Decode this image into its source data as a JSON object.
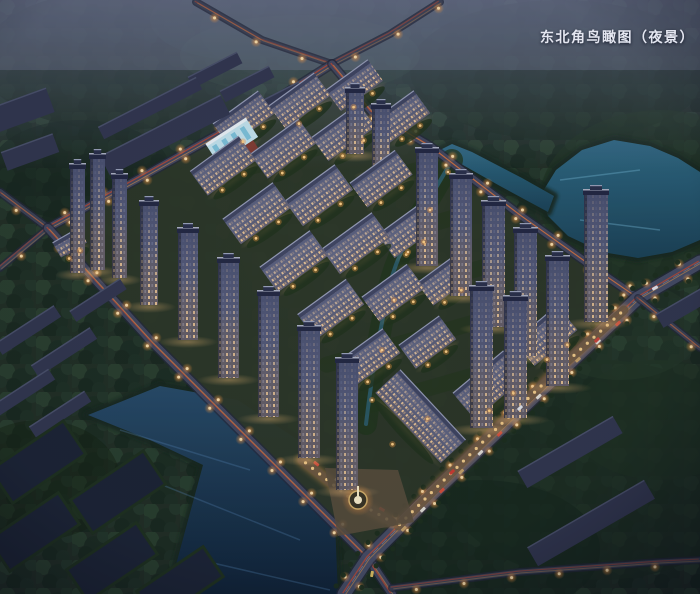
{
  "caption": {
    "text": "东北角鸟瞰图（夜景）"
  },
  "palette": {
    "night_haze": "#7a7ea5",
    "forest": "#1f2d20",
    "water_teal": "#2f6b85",
    "water_navy": "#12283c",
    "road_surface": "#4a4f68",
    "street_lamp": "#ffc270",
    "light_trail_red": "#c14a32",
    "light_trail_amber": "#e09a4f",
    "window_warm": "#ffd9a4",
    "facade": "#4e5370",
    "roof": "#2e3350",
    "retail_glow": "#fca54d"
  },
  "scene": {
    "lakes": [
      {
        "name": "northeast-lake",
        "fill": "teal",
        "points": [
          [
            540,
            196
          ],
          [
            556,
            170
          ],
          [
            582,
            150
          ],
          [
            614,
            140
          ],
          [
            650,
            146
          ],
          [
            678,
            158
          ],
          [
            700,
            172
          ],
          [
            700,
            240
          ],
          [
            672,
            252
          ],
          [
            638,
            258
          ],
          [
            602,
            252
          ],
          [
            568,
            236
          ],
          [
            548,
            216
          ]
        ]
      },
      {
        "name": "lake-inlet",
        "fill": "teal",
        "points": [
          [
            548,
            212
          ],
          [
            500,
            186
          ],
          [
            454,
            160
          ],
          [
            440,
            150
          ],
          [
            452,
            144
          ],
          [
            472,
            152
          ],
          [
            522,
            178
          ],
          [
            554,
            196
          ]
        ]
      },
      {
        "name": "southwest-lake",
        "fill": "navy",
        "points": [
          [
            88,
            415
          ],
          [
            160,
            386
          ],
          [
            238,
            400
          ],
          [
            304,
            444
          ],
          [
            334,
            498
          ],
          [
            338,
            594
          ],
          [
            168,
            594
          ],
          [
            203,
            465
          ],
          [
            150,
            440
          ]
        ]
      }
    ],
    "roads": [
      {
        "name": "forest-road-west",
        "kind": "minor",
        "w": 5,
        "points": [
          [
            196,
            2
          ],
          [
            262,
            40
          ],
          [
            332,
            64
          ]
        ]
      },
      {
        "name": "forest-road-east",
        "kind": "minor",
        "w": 5,
        "points": [
          [
            332,
            64
          ],
          [
            390,
            34
          ],
          [
            440,
            2
          ]
        ]
      },
      {
        "name": "northwest-perimeter-road",
        "kind": "perimeter",
        "w": 7,
        "points": [
          [
            48,
            228
          ],
          [
            140,
            178
          ],
          [
            240,
            122
          ],
          [
            332,
            64
          ]
        ]
      },
      {
        "name": "west-approach-road",
        "kind": "minor",
        "w": 6,
        "points": [
          [
            0,
            192
          ],
          [
            48,
            228
          ]
        ]
      },
      {
        "name": "west-approach-road-south",
        "kind": "minor",
        "w": 5,
        "points": [
          [
            0,
            268
          ],
          [
            48,
            228
          ]
        ]
      },
      {
        "name": "southwest-perimeter-road",
        "kind": "perimeter",
        "w": 8,
        "points": [
          [
            48,
            228
          ],
          [
            152,
            342
          ],
          [
            258,
            448
          ],
          [
            368,
            558
          ],
          [
            392,
            594
          ]
        ]
      },
      {
        "name": "northeast-lakeside-road",
        "kind": "perimeter",
        "w": 7,
        "points": [
          [
            332,
            64
          ],
          [
            372,
            112
          ],
          [
            430,
            146
          ],
          [
            520,
            215
          ],
          [
            600,
            272
          ],
          [
            638,
            298
          ]
        ]
      },
      {
        "name": "southeast-arterial-road",
        "kind": "arterial",
        "w": 13,
        "points": [
          [
            700,
            262
          ],
          [
            638,
            298
          ],
          [
            520,
            410
          ],
          [
            430,
            496
          ],
          [
            368,
            558
          ],
          [
            344,
            594
          ]
        ]
      },
      {
        "name": "east-spur-road",
        "kind": "minor",
        "w": 5,
        "points": [
          [
            638,
            298
          ],
          [
            700,
            348
          ]
        ]
      },
      {
        "name": "south-edge-road",
        "kind": "minor",
        "w": 5,
        "points": [
          [
            392,
            588
          ],
          [
            520,
            572
          ],
          [
            660,
            562
          ],
          [
            700,
            560
          ]
        ]
      }
    ],
    "green_bands": [
      {
        "cx": 320,
        "cy": 147
      },
      {
        "cx": 330,
        "cy": 195
      },
      {
        "cx": 365,
        "cy": 243
      },
      {
        "cx": 400,
        "cy": 291
      },
      {
        "cx": 420,
        "cy": 338
      },
      {
        "cx": 440,
        "cy": 385
      }
    ],
    "stream_path": "M452,160 C430,200 398,244 388,292 C380,332 372,372 366,424",
    "buildings": [
      {
        "t": "tower",
        "x": 70,
        "y": 168,
        "w": 15,
        "h": 105
      },
      {
        "t": "tower",
        "x": 90,
        "y": 158,
        "w": 15,
        "h": 112
      },
      {
        "t": "tower",
        "x": 112,
        "y": 178,
        "w": 15,
        "h": 100
      },
      {
        "t": "tower",
        "x": 140,
        "y": 205,
        "w": 18,
        "h": 100
      },
      {
        "t": "tower",
        "x": 178,
        "y": 232,
        "w": 20,
        "h": 108
      },
      {
        "t": "tower",
        "x": 218,
        "y": 262,
        "w": 21,
        "h": 116
      },
      {
        "t": "tower",
        "x": 258,
        "y": 295,
        "w": 21,
        "h": 122
      },
      {
        "t": "tower",
        "x": 298,
        "y": 330,
        "w": 22,
        "h": 128
      },
      {
        "t": "tower",
        "x": 336,
        "y": 362,
        "w": 22,
        "h": 128
      },
      {
        "t": "tower",
        "x": 346,
        "y": 92,
        "w": 18,
        "h": 62
      },
      {
        "t": "tower",
        "x": 372,
        "y": 108,
        "w": 18,
        "h": 66
      },
      {
        "t": "tower",
        "x": 416,
        "y": 152,
        "w": 22,
        "h": 114
      },
      {
        "t": "tower",
        "x": 450,
        "y": 178,
        "w": 22,
        "h": 118
      },
      {
        "t": "tower",
        "x": 482,
        "y": 205,
        "w": 23,
        "h": 122
      },
      {
        "t": "tower",
        "x": 514,
        "y": 232,
        "w": 23,
        "h": 124
      },
      {
        "t": "tower",
        "x": 546,
        "y": 260,
        "w": 23,
        "h": 126
      },
      {
        "t": "tower",
        "x": 584,
        "y": 194,
        "w": 24,
        "h": 128
      },
      {
        "t": "tower",
        "x": 470,
        "y": 290,
        "w": 23,
        "h": 138
      },
      {
        "t": "tower",
        "x": 504,
        "y": 300,
        "w": 23,
        "h": 118
      },
      {
        "t": "slab",
        "cx": 252,
        "cy": 130,
        "len": 56,
        "h": 24,
        "rot": -36
      },
      {
        "t": "slab",
        "cx": 308,
        "cy": 112,
        "len": 56,
        "h": 24,
        "rot": -36
      },
      {
        "t": "slab",
        "cx": 362,
        "cy": 96,
        "len": 52,
        "h": 22,
        "rot": -36
      },
      {
        "t": "slab",
        "cx": 232,
        "cy": 178,
        "len": 60,
        "h": 26,
        "rot": -36
      },
      {
        "t": "slab",
        "cx": 292,
        "cy": 161,
        "len": 60,
        "h": 26,
        "rot": -36
      },
      {
        "t": "slab",
        "cx": 352,
        "cy": 144,
        "len": 58,
        "h": 25,
        "rot": -36
      },
      {
        "t": "slab",
        "cx": 410,
        "cy": 128,
        "len": 50,
        "h": 24,
        "rot": -36
      },
      {
        "t": "slab",
        "cx": 266,
        "cy": 226,
        "len": 62,
        "h": 27,
        "rot": -36
      },
      {
        "t": "slab",
        "cx": 328,
        "cy": 208,
        "len": 62,
        "h": 27,
        "rot": -36
      },
      {
        "t": "slab",
        "cx": 390,
        "cy": 191,
        "len": 56,
        "h": 26,
        "rot": -36
      },
      {
        "t": "slab",
        "cx": 303,
        "cy": 274,
        "len": 62,
        "h": 27,
        "rot": -36
      },
      {
        "t": "slab",
        "cx": 365,
        "cy": 256,
        "len": 62,
        "h": 27,
        "rot": -36
      },
      {
        "t": "slab",
        "cx": 414,
        "cy": 244,
        "len": 48,
        "h": 25,
        "rot": -36
      },
      {
        "t": "slab",
        "cx": 340,
        "cy": 322,
        "len": 60,
        "h": 27,
        "rot": -36
      },
      {
        "t": "slab",
        "cx": 402,
        "cy": 305,
        "len": 56,
        "h": 26,
        "rot": -36
      },
      {
        "t": "slab",
        "cx": 452,
        "cy": 292,
        "len": 46,
        "h": 24,
        "rot": -36
      },
      {
        "t": "slab",
        "cx": 377,
        "cy": 370,
        "len": 58,
        "h": 26,
        "rot": -36
      },
      {
        "t": "slab",
        "cx": 436,
        "cy": 354,
        "len": 50,
        "h": 25,
        "rot": -36
      },
      {
        "t": "slab",
        "cx": 500,
        "cy": 398,
        "len": 66,
        "h": 30,
        "rot": -40
      },
      {
        "t": "slab",
        "cx": 556,
        "cy": 348,
        "len": 56,
        "h": 28,
        "rot": -40
      },
      {
        "t": "slab",
        "cx": 408,
        "cy": 428,
        "len": 96,
        "h": 30,
        "rot": 47
      },
      {
        "t": "slab",
        "cx": 74,
        "cy": 250,
        "len": 30,
        "h": 13,
        "rot": -30
      },
      {
        "t": "kg",
        "cx": 238,
        "cy": 150,
        "len": 48,
        "h": 20,
        "rot": -33
      },
      {
        "t": "dark",
        "cx": 165,
        "cy": 135,
        "len": 135,
        "h": 22,
        "rot": -27
      },
      {
        "t": "dark",
        "cx": 150,
        "cy": 108,
        "len": 110,
        "h": 14,
        "rot": -27
      },
      {
        "t": "dark",
        "cx": 215,
        "cy": 70,
        "len": 55,
        "h": 13,
        "rot": -27
      },
      {
        "t": "dark",
        "cx": 247,
        "cy": 84,
        "len": 55,
        "h": 13,
        "rot": -27
      },
      {
        "t": "dark",
        "cx": 279,
        "cy": 98,
        "len": 50,
        "h": 12,
        "rot": -27
      },
      {
        "t": "dark",
        "cx": 28,
        "cy": 330,
        "len": 70,
        "h": 14,
        "rot": -33
      },
      {
        "t": "dark",
        "cx": 64,
        "cy": 352,
        "len": 70,
        "h": 14,
        "rot": -33
      },
      {
        "t": "dark",
        "cx": 24,
        "cy": 392,
        "len": 66,
        "h": 13,
        "rot": -33
      },
      {
        "t": "dark",
        "cx": 60,
        "cy": 414,
        "len": 66,
        "h": 13,
        "rot": -33
      },
      {
        "t": "dark",
        "cx": 98,
        "cy": 300,
        "len": 60,
        "h": 13,
        "rot": -33
      },
      {
        "t": "dark",
        "cx": 22,
        "cy": 110,
        "len": 60,
        "h": 26,
        "rot": -20
      },
      {
        "t": "dark",
        "cx": 30,
        "cy": 152,
        "len": 55,
        "h": 20,
        "rot": -20
      },
      {
        "t": "dark",
        "cx": 591,
        "cy": 523,
        "len": 135,
        "h": 22,
        "rot": -30
      },
      {
        "t": "dark",
        "cx": 570,
        "cy": 452,
        "len": 110,
        "h": 20,
        "rot": -30
      },
      {
        "t": "dark",
        "cx": 682,
        "cy": 308,
        "len": 52,
        "h": 16,
        "rot": -30
      },
      {
        "t": "plot",
        "cx": 38,
        "cy": 462,
        "len": 88,
        "h": 40,
        "rot": -34
      },
      {
        "t": "plot",
        "cx": 118,
        "cy": 492,
        "len": 88,
        "h": 40,
        "rot": -34
      },
      {
        "t": "plot",
        "cx": 34,
        "cy": 532,
        "len": 84,
        "h": 38,
        "rot": -34
      },
      {
        "t": "plot",
        "cx": 112,
        "cy": 562,
        "len": 84,
        "h": 38,
        "rot": -34
      },
      {
        "t": "plot",
        "cx": 180,
        "cy": 584,
        "len": 80,
        "h": 36,
        "rot": -34
      }
    ],
    "retail": {
      "main": [
        [
          624,
          310
        ],
        [
          560,
          368
        ],
        [
          495,
          430
        ],
        [
          436,
          488
        ],
        [
          398,
          526
        ]
      ],
      "west": [
        [
          302,
          460
        ],
        [
          350,
          498
        ],
        [
          392,
          522
        ]
      ]
    },
    "plaza": {
      "pavement": [
        [
          325,
          468
        ],
        [
          398,
          470
        ],
        [
          414,
          522
        ],
        [
          338,
          536
        ]
      ],
      "fountain": {
        "x": 358,
        "y": 500
      }
    },
    "cars": [
      {
        "x": 655,
        "y": 288,
        "c": "#e9e9f2",
        "r": -30
      },
      {
        "x": 597,
        "y": 340,
        "c": "#cf4438",
        "r": -43
      },
      {
        "x": 520,
        "y": 408,
        "c": "#e6e8ef",
        "r": -43
      },
      {
        "x": 452,
        "y": 472,
        "c": "#d23b2f",
        "r": -43
      },
      {
        "x": 372,
        "y": 574,
        "c": "#e0c060",
        "r": -80
      }
    ],
    "stream_lights": [
      [
        448,
        172
      ],
      [
        430,
        210
      ],
      [
        408,
        252
      ],
      [
        394,
        300
      ],
      [
        382,
        350
      ],
      [
        372,
        400
      ]
    ]
  }
}
